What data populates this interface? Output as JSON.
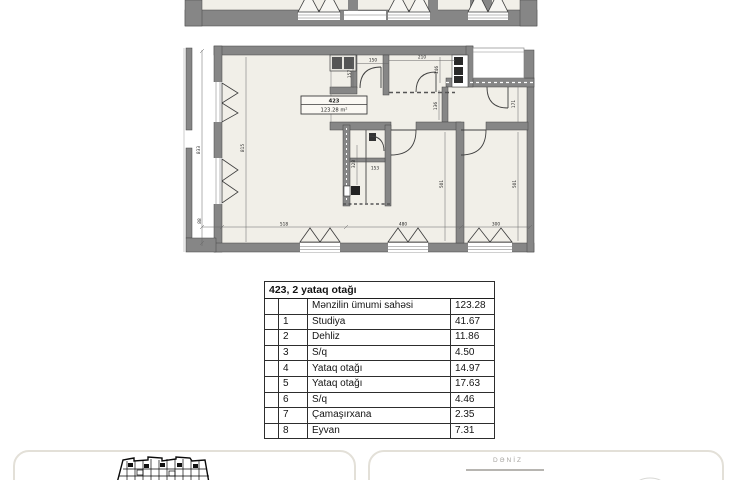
{
  "plan": {
    "unit_box": {
      "number": "423",
      "area": "123.28 m²"
    },
    "dims": {
      "left_outer": "833",
      "left_inner": "815",
      "top_1": "150",
      "top_2": "210",
      "top_v1": "157",
      "top_v2": "146",
      "hall_v": "136",
      "right_room_v": "171",
      "bath_v": "328",
      "bath_h": "153",
      "bedroom1_v": "501",
      "bedroom2_v": "501",
      "bottom_left": "88",
      "bottom_1": "518",
      "bottom_2": "480",
      "bottom_3": "300"
    },
    "colors": {
      "wall": "#868686",
      "floor": "#f1efe8",
      "outline": "#454545"
    }
  },
  "area_table": {
    "title": "423, 2 yataq otağı",
    "rows": [
      {
        "num": "",
        "name": "Mənzilin ümumi sahəsi",
        "value": "123.28"
      },
      {
        "num": "1",
        "name": "Studiya",
        "value": "41.67"
      },
      {
        "num": "2",
        "name": "Dehliz",
        "value": "11.86"
      },
      {
        "num": "3",
        "name": "S/q",
        "value": "4.50"
      },
      {
        "num": "4",
        "name": "Yataq otağı",
        "value": "14.97"
      },
      {
        "num": "5",
        "name": "Yataq otağı",
        "value": "17.63"
      },
      {
        "num": "6",
        "name": "S/q",
        "value": "4.46"
      },
      {
        "num": "7",
        "name": "Çamaşırxana",
        "value": "2.35"
      },
      {
        "num": "8",
        "name": "Eyvan",
        "value": "7.31"
      }
    ]
  },
  "footer": {
    "sea_label": "DƏNİZ",
    "card_border": "#e3e0d8",
    "muted_text": "#a7a5a1"
  }
}
